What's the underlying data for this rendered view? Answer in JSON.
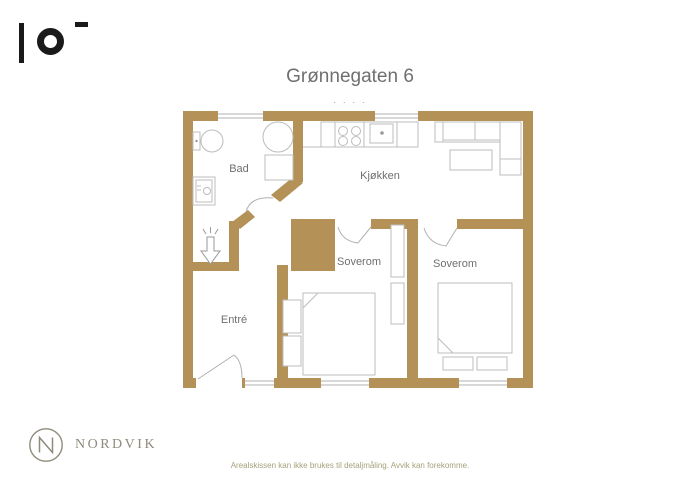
{
  "header": {
    "title": "Grønnegaten 6",
    "separator_dots": "· · · ·"
  },
  "rooms": {
    "bathroom": "Bad",
    "kitchen": "Kjøkken",
    "bedroom1": "Soverom",
    "bedroom2": "Soverom",
    "entrance": "Entré"
  },
  "footer": {
    "agency_name": "NORDVIK",
    "disclaimer": "Arealskissen kan ikke brukes til detaljmåling. Avvik kan forekomme."
  },
  "colors": {
    "wall": "#b49257",
    "furniture_outline": "#bcbcbc",
    "door_swing": "#b0b0b0",
    "room_label": "#6f6f6f",
    "brand": "#8f8b7c",
    "disclaimer_text": "#a5a17b",
    "corner_logo": "#1a1a1a"
  },
  "fixtures": [
    "toilet",
    "corner-shower",
    "bath-cabinet",
    "washing-machine",
    "entry-arrow",
    "kitchen-counter",
    "stove",
    "kitchen-sink",
    "sofa",
    "coffee-table",
    "double-bed",
    "pillows",
    "wardrobe",
    "window",
    "door-swing",
    "chimney-shaft"
  ]
}
